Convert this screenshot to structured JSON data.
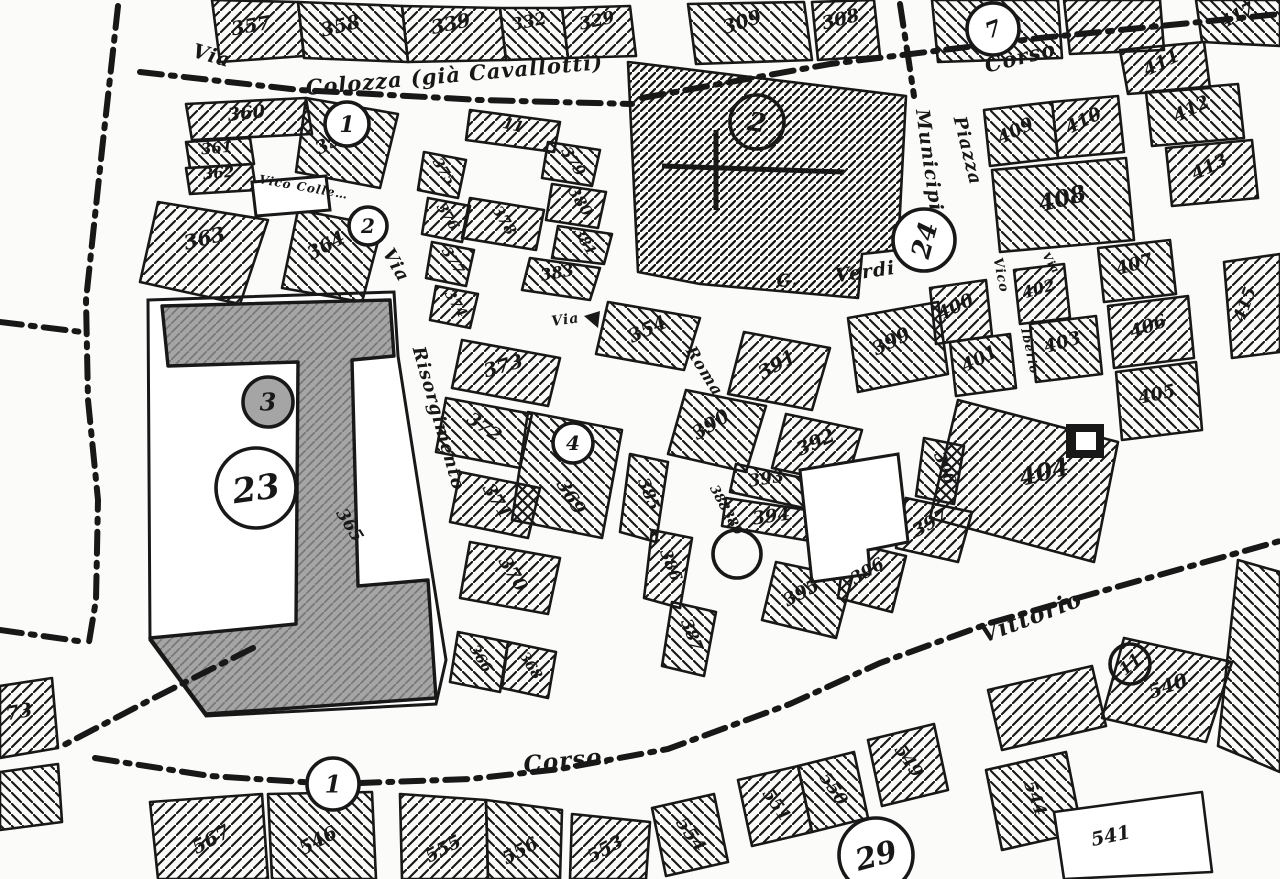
{
  "document": {
    "kind": "scanned black-and-white cadastral map",
    "language": "Italian"
  },
  "map": {
    "width": 1280,
    "height": 879,
    "colors": {
      "paper": "#fbfbf9",
      "ink": "#181818",
      "shade": "#a5a5a5",
      "shade_line": "#787878"
    },
    "street_labels": [
      {
        "t": "Via",
        "x": 210,
        "y": 62,
        "rot": 16,
        "fs": 20
      },
      {
        "t": "Colozza (già Cavallotti)",
        "x": 455,
        "y": 82,
        "rot": -5,
        "fs": 21
      },
      {
        "t": "Corso",
        "x": 1022,
        "y": 64,
        "rot": -14,
        "fs": 21
      },
      {
        "t": "Municipio",
        "x": 924,
        "y": 168,
        "rot": 82,
        "fs": 19
      },
      {
        "t": "Piazza",
        "x": 962,
        "y": 152,
        "rot": 76,
        "fs": 18
      },
      {
        "t": "G.",
        "x": 788,
        "y": 286,
        "rot": -5,
        "fs": 17
      },
      {
        "t": "Verdi",
        "x": 866,
        "y": 278,
        "rot": -8,
        "fs": 19
      },
      {
        "t": "Via",
        "x": 391,
        "y": 268,
        "rot": 60,
        "fs": 18
      },
      {
        "t": "Risorgimento",
        "x": 433,
        "y": 420,
        "rot": 74,
        "fs": 18
      },
      {
        "t": "Roma",
        "x": 700,
        "y": 374,
        "rot": 58,
        "fs": 16
      },
      {
        "t": "Via",
        "x": 566,
        "y": 324,
        "rot": -8,
        "fs": 14
      },
      {
        "t": "Vico Colle…",
        "x": 303,
        "y": 191,
        "rot": 10,
        "fs": 12
      },
      {
        "t": "Vico",
        "x": 997,
        "y": 276,
        "rot": 78,
        "fs": 13
      },
      {
        "t": "Iberio",
        "x": 1026,
        "y": 352,
        "rot": 78,
        "fs": 12
      },
      {
        "t": "Via",
        "x": 1048,
        "y": 265,
        "rot": 58,
        "fs": 11
      },
      {
        "t": "Corso.",
        "x": 568,
        "y": 768,
        "rot": -6,
        "fs": 23
      },
      {
        "t": "Vittorio",
        "x": 1034,
        "y": 624,
        "rot": -21,
        "fs": 23
      }
    ],
    "parcels": [
      {
        "n": "357",
        "pts": "212,0 298,2 304,56 220,62",
        "lx": 252,
        "ly": 32,
        "rot": -10,
        "fs": 19,
        "h": 0
      },
      {
        "n": "358",
        "pts": "298,2 402,6 408,62 304,58",
        "lx": 342,
        "ly": 32,
        "rot": -14,
        "fs": 19,
        "h": 1
      },
      {
        "n": "339",
        "pts": "402,6 500,8 506,60 408,62",
        "lx": 452,
        "ly": 30,
        "rot": -12,
        "fs": 19,
        "h": 0
      },
      {
        "n": "332",
        "pts": "500,8 562,8 568,58 506,60",
        "lx": 530,
        "ly": 27,
        "rot": -12,
        "fs": 17,
        "h": 1
      },
      {
        "n": "329",
        "pts": "562,8 630,6 636,56 568,58",
        "lx": 598,
        "ly": 26,
        "rot": -12,
        "fs": 17,
        "h": 0
      },
      {
        "n": "309",
        "pts": "688,4 804,2 812,60 696,64",
        "lx": 744,
        "ly": 28,
        "rot": -18,
        "fs": 19,
        "h": 1
      },
      {
        "n": "308",
        "pts": "812,2 874,0 880,56 818,60",
        "lx": 842,
        "ly": 25,
        "rot": -14,
        "fs": 18,
        "h": 0
      },
      {
        "n": "",
        "pts": "932,0 1058,0 1062,58 938,62",
        "h": 1
      },
      {
        "n": "",
        "pts": "1064,0 1160,0 1164,50 1070,54",
        "h": 0
      },
      {
        "n": "417",
        "pts": "1196,0 1280,0 1280,46 1202,42",
        "lx": 1240,
        "ly": 20,
        "rot": -28,
        "fs": 17,
        "h": 1
      },
      {
        "n": "411",
        "pts": "1120,50 1204,42 1210,88 1128,94",
        "lx": 1164,
        "ly": 68,
        "rot": -26,
        "fs": 18,
        "h": 0
      },
      {
        "n": "412",
        "pts": "1146,92 1238,84 1244,138 1152,146",
        "lx": 1194,
        "ly": 114,
        "rot": -26,
        "fs": 18,
        "h": 1
      },
      {
        "n": "413",
        "pts": "1166,148 1252,140 1258,198 1172,206",
        "lx": 1212,
        "ly": 172,
        "rot": -26,
        "fs": 18,
        "h": 0
      },
      {
        "n": "409",
        "pts": "984,110 1052,102 1058,158 990,166",
        "lx": 1018,
        "ly": 136,
        "rot": -26,
        "fs": 18,
        "h": 1
      },
      {
        "n": "410",
        "pts": "1052,102 1118,96 1124,152 1058,158",
        "lx": 1086,
        "ly": 126,
        "rot": -26,
        "fs": 18,
        "h": 0
      },
      {
        "n": "408",
        "pts": "992,170 1126,158 1134,240 1000,252",
        "lx": 1064,
        "ly": 206,
        "rot": -14,
        "fs": 23,
        "h": 1
      },
      {
        "n": "415",
        "pts": "1224,262 1280,254 1280,352 1232,358",
        "lx": 1250,
        "ly": 306,
        "rot": -70,
        "fs": 17,
        "h": 0
      },
      {
        "n": "407",
        "pts": "1098,248 1170,240 1176,294 1104,302",
        "lx": 1136,
        "ly": 270,
        "rot": -16,
        "fs": 18,
        "h": 1
      },
      {
        "n": "406",
        "pts": "1108,306 1188,296 1194,358 1114,368",
        "lx": 1150,
        "ly": 332,
        "rot": -20,
        "fs": 18,
        "h": 0
      },
      {
        "n": "405",
        "pts": "1116,372 1196,362 1202,430 1122,440",
        "lx": 1158,
        "ly": 400,
        "rot": -12,
        "fs": 18,
        "h": 1
      },
      {
        "n": "402",
        "pts": "1014,270 1064,264 1070,318 1020,324",
        "lx": 1040,
        "ly": 294,
        "rot": -16,
        "fs": 16,
        "h": 0
      },
      {
        "n": "403",
        "pts": "1030,324 1096,316 1102,374 1036,382",
        "lx": 1064,
        "ly": 348,
        "rot": -16,
        "fs": 18,
        "h": 1
      },
      {
        "n": "400",
        "pts": "930,288 986,280 992,336 936,344",
        "lx": 958,
        "ly": 312,
        "rot": -26,
        "fs": 18,
        "h": 0
      },
      {
        "n": "401",
        "pts": "950,342 1010,334 1016,388 956,396",
        "lx": 982,
        "ly": 364,
        "rot": -26,
        "fs": 18,
        "h": 1
      },
      {
        "n": "404",
        "pts": "958,400 1118,442 1094,562 930,518",
        "lx": 1046,
        "ly": 480,
        "rot": -14,
        "fs": 24,
        "h": 0
      },
      {
        "n": "399",
        "pts": "848,318 938,302 948,374 858,392",
        "lx": 894,
        "ly": 347,
        "rot": -26,
        "fs": 19,
        "h": 1
      },
      {
        "n": "391",
        "pts": "744,332 830,348 812,410 728,394",
        "lx": 780,
        "ly": 370,
        "rot": -30,
        "fs": 19,
        "h": 0
      },
      {
        "n": "390",
        "pts": "686,390 766,406 746,472 668,454",
        "lx": 714,
        "ly": 430,
        "rot": -32,
        "fs": 19,
        "h": 1
      },
      {
        "n": "392",
        "pts": "786,414 862,430 846,484 772,468",
        "lx": 818,
        "ly": 448,
        "rot": -24,
        "fs": 19,
        "h": 0
      },
      {
        "n": "393",
        "pts": "736,464 812,480 804,508 730,492",
        "lx": 767,
        "ly": 484,
        "rot": -9,
        "fs": 17,
        "h": 1
      },
      {
        "n": "394",
        "pts": "726,498 820,512 816,542 722,526",
        "lx": 772,
        "ly": 522,
        "rot": -8,
        "fs": 18,
        "h": 0
      },
      {
        "n": "388",
        "lx": 716,
        "ly": 500,
        "rot": 62,
        "fs": 13,
        "h": -1
      },
      {
        "n": "389",
        "lx": 729,
        "ly": 524,
        "rot": 62,
        "fs": 13,
        "h": -1
      },
      {
        "n": "395",
        "pts": "776,562 852,578 836,638 762,620",
        "lx": 804,
        "ly": 598,
        "rot": -28,
        "fs": 18,
        "h": 1
      },
      {
        "n": "396",
        "pts": "846,542 906,556 892,612 838,598",
        "lx": 870,
        "ly": 576,
        "rot": -30,
        "fs": 17,
        "h": 0
      },
      {
        "n": "396",
        "pts": "924,438 964,446 954,504 916,496",
        "lx": 940,
        "ly": 470,
        "rot": 68,
        "fs": 16,
        "h": 1
      },
      {
        "n": "397",
        "pts": "906,498 972,512 958,562 896,548",
        "lx": 933,
        "ly": 528,
        "rot": -30,
        "fs": 18,
        "h": 0
      },
      {
        "n": "385",
        "pts": "630,454 668,462 656,542 620,532",
        "lx": 644,
        "ly": 496,
        "rot": 68,
        "fs": 16,
        "h": 1
      },
      {
        "n": "386",
        "pts": "652,530 692,538 680,608 644,598",
        "lx": 666,
        "ly": 567,
        "rot": 68,
        "fs": 16,
        "h": 0
      },
      {
        "n": "387",
        "pts": "672,602 716,612 704,676 662,666",
        "lx": 687,
        "ly": 637,
        "rot": 68,
        "fs": 16,
        "h": 1
      },
      {
        "n": "11",
        "pts": "470,110 560,122 554,152 466,140",
        "lx": 512,
        "ly": 130,
        "rot": 14,
        "fs": 15,
        "h": 0
      },
      {
        "n": "379",
        "pts": "548,142 600,150 592,186 542,178",
        "lx": 569,
        "ly": 164,
        "rot": 58,
        "fs": 15,
        "h": 1
      },
      {
        "n": "380",
        "pts": "552,184 606,192 598,228 546,220",
        "lx": 576,
        "ly": 204,
        "rot": 58,
        "fs": 15,
        "h": 0
      },
      {
        "n": "381",
        "pts": "558,226 612,234 604,264 552,258",
        "lx": 581,
        "ly": 244,
        "rot": 58,
        "fs": 14,
        "h": 1
      },
      {
        "n": "378",
        "pts": "470,198 544,210 536,250 462,238",
        "lx": 500,
        "ly": 223,
        "rot": 58,
        "fs": 15,
        "h": 0
      },
      {
        "n": "383",
        "pts": "530,258 600,268 590,300 522,290",
        "lx": 558,
        "ly": 278,
        "rot": -10,
        "fs": 16,
        "h": 1
      },
      {
        "n": "375",
        "pts": "424,152 466,160 458,198 418,190",
        "lx": 440,
        "ly": 174,
        "rot": 58,
        "fs": 14,
        "h": 1
      },
      {
        "n": "376",
        "pts": "428,198 470,206 462,242 422,234",
        "lx": 444,
        "ly": 219,
        "rot": 58,
        "fs": 14,
        "h": 0
      },
      {
        "n": "377",
        "pts": "432,242 474,250 466,286 426,278",
        "lx": 449,
        "ly": 263,
        "rot": 58,
        "fs": 14,
        "h": 1
      },
      {
        "n": "374",
        "pts": "436,286 478,294 470,328 430,320",
        "lx": 452,
        "ly": 306,
        "rot": 58,
        "fs": 14,
        "h": 0
      },
      {
        "n": "354",
        "pts": "608,302 700,318 684,370 596,354",
        "lx": 650,
        "ly": 335,
        "rot": -24,
        "fs": 19,
        "h": 1
      },
      {
        "n": "373",
        "pts": "462,340 560,358 548,406 452,388",
        "lx": 505,
        "ly": 372,
        "rot": -16,
        "fs": 19,
        "h": 0
      },
      {
        "n": "372",
        "pts": "446,398 532,414 520,468 436,452",
        "lx": 481,
        "ly": 432,
        "rot": 34,
        "fs": 18,
        "h": 1
      },
      {
        "n": "371",
        "pts": "460,472 540,488 528,538 450,522",
        "lx": 492,
        "ly": 504,
        "rot": 58,
        "fs": 18,
        "h": 0
      },
      {
        "n": "369",
        "pts": "528,412 622,430 602,538 512,520",
        "lx": 566,
        "ly": 500,
        "rot": 58,
        "fs": 18,
        "h": 1
      },
      {
        "n": "370",
        "pts": "470,542 560,558 548,614 460,598",
        "lx": 508,
        "ly": 577,
        "rot": 58,
        "fs": 18,
        "h": 0
      },
      {
        "n": "366",
        "pts": "458,632 508,642 500,692 450,682",
        "lx": 477,
        "ly": 661,
        "rot": 58,
        "fs": 14,
        "h": 1
      },
      {
        "n": "368",
        "pts": "508,642 556,652 548,698 502,688",
        "lx": 527,
        "ly": 668,
        "rot": 58,
        "fs": 14,
        "h": 0
      },
      {
        "n": "360",
        "pts": "186,104 306,98 312,134 192,140",
        "lx": 247,
        "ly": 119,
        "rot": -6,
        "fs": 18,
        "h": 0
      },
      {
        "n": "359",
        "pts": "306,98 398,114 380,188 296,172",
        "lx": 336,
        "ly": 146,
        "rot": -28,
        "fs": 18,
        "h": 1
      },
      {
        "n": "361",
        "pts": "186,142 250,138 254,164 190,168",
        "lx": 217,
        "ly": 153,
        "rot": -5,
        "fs": 15,
        "h": 1
      },
      {
        "n": "362",
        "pts": "186,168 252,164 256,190 190,194",
        "lx": 219,
        "ly": 178,
        "rot": -5,
        "fs": 15,
        "h": 0
      },
      {
        "n": "363",
        "pts": "158,202 268,220 240,304 140,282",
        "lx": 206,
        "ly": 245,
        "rot": -14,
        "fs": 20,
        "h": 0
      },
      {
        "n": "364",
        "pts": "298,210 382,226 362,302 282,288",
        "lx": 329,
        "ly": 251,
        "rot": -28,
        "fs": 19,
        "h": 1
      },
      {
        "n": "365",
        "lx": 345,
        "ly": 528,
        "rot": 58,
        "fs": 17,
        "h": -1
      },
      {
        "n": "567",
        "pts": "150,802 262,794 268,879 158,879",
        "lx": 214,
        "ly": 845,
        "rot": -28,
        "fs": 19,
        "h": 0
      },
      {
        "n": "546",
        "pts": "268,794 372,792 376,879 272,879",
        "lx": 321,
        "ly": 846,
        "rot": -28,
        "fs": 19,
        "h": 1
      },
      {
        "n": "555",
        "pts": "400,794 486,800 488,879 402,879",
        "lx": 446,
        "ly": 854,
        "rot": -28,
        "fs": 18,
        "h": 0
      },
      {
        "n": "556",
        "pts": "486,800 562,810 560,879 488,879",
        "lx": 523,
        "ly": 856,
        "rot": -28,
        "fs": 18,
        "h": 1
      },
      {
        "n": "553",
        "pts": "572,814 650,822 646,879 570,879",
        "lx": 608,
        "ly": 854,
        "rot": -28,
        "fs": 18,
        "h": 0
      },
      {
        "n": "554",
        "pts": "652,808 714,794 728,862 666,876",
        "lx": 686,
        "ly": 838,
        "rot": 55,
        "fs": 18,
        "h": 1
      },
      {
        "n": "551",
        "pts": "738,780 798,766 812,832 752,846",
        "lx": 772,
        "ly": 808,
        "rot": 55,
        "fs": 17,
        "h": 0
      },
      {
        "n": "550",
        "pts": "798,766 854,752 868,818 812,832",
        "lx": 829,
        "ly": 792,
        "rot": 55,
        "fs": 17,
        "h": 1
      },
      {
        "n": "549",
        "pts": "868,740 934,724 948,790 882,806",
        "lx": 904,
        "ly": 764,
        "rot": 55,
        "fs": 17,
        "h": 0
      },
      {
        "n": "544",
        "pts": "986,770 1066,752 1082,832 1002,850",
        "lx": 1030,
        "ly": 800,
        "rot": 70,
        "fs": 17,
        "h": 1
      },
      {
        "n": "541",
        "pts": "1054,812 1202,792 1212,872 1064,879",
        "lx": 1112,
        "ly": 842,
        "rot": -12,
        "fs": 19,
        "h": "white"
      },
      {
        "n": "540",
        "pts": "1124,638 1232,662 1206,742 1102,718",
        "lx": 1170,
        "ly": 692,
        "rot": -20,
        "fs": 19,
        "h": 0
      },
      {
        "n": "",
        "pts": "1238,560 1280,572 1280,772 1218,746",
        "h": 1
      },
      {
        "n": "73",
        "pts": "0,686 52,678 58,748 0,758",
        "lx": 20,
        "ly": 718,
        "rot": -10,
        "fs": 19,
        "h": 0
      },
      {
        "n": "",
        "pts": "0,772 58,764 62,822 0,830",
        "h": 1
      },
      {
        "n": "",
        "pts": "988,690 1092,666 1106,726 1002,750",
        "h": 0
      },
      {
        "n": "",
        "pts": "628,62 906,96 898,250 862,254 858,298 700,284 638,272",
        "h": 2
      }
    ],
    "circles": [
      {
        "n": "1",
        "cx": 347,
        "cy": 124,
        "r": 22,
        "fs": 22,
        "rot": 0,
        "fill": "white"
      },
      {
        "n": "2",
        "cx": 368,
        "cy": 226,
        "r": 19,
        "fs": 20,
        "rot": 0,
        "fill": "white"
      },
      {
        "n": "2",
        "cx": 757,
        "cy": 122,
        "r": 27,
        "fs": 26,
        "rot": 10,
        "fill": "none"
      },
      {
        "n": "24",
        "cx": 924,
        "cy": 240,
        "r": 31,
        "fs": 26,
        "rot": -75,
        "fill": "white"
      },
      {
        "n": "4",
        "cx": 573,
        "cy": 443,
        "r": 20,
        "fs": 20,
        "rot": 0,
        "fill": "white"
      },
      {
        "n": "3",
        "cx": 268,
        "cy": 402,
        "r": 25,
        "fs": 24,
        "rot": 0,
        "fill": "gray"
      },
      {
        "n": "23",
        "cx": 256,
        "cy": 488,
        "r": 40,
        "fs": 34,
        "rot": -8,
        "fill": "white"
      },
      {
        "n": "7",
        "cx": 993,
        "cy": 29,
        "r": 26,
        "fs": 22,
        "rot": -20,
        "fill": "white"
      },
      {
        "n": "1",
        "cx": 333,
        "cy": 784,
        "r": 26,
        "fs": 24,
        "rot": 0,
        "fill": "white"
      },
      {
        "n": "29",
        "cx": 876,
        "cy": 855,
        "r": 37,
        "fs": 30,
        "rot": -15,
        "fill": "white"
      },
      {
        "n": "11",
        "cx": 1130,
        "cy": 664,
        "r": 20,
        "fs": 17,
        "rot": -40,
        "fill": "none"
      },
      {
        "n": "",
        "cx": 737,
        "cy": 554,
        "r": 24,
        "fs": 0,
        "rot": 0,
        "fill": "none"
      }
    ],
    "boundary_lines": [
      {
        "pts": "140,72 300,90 480,100 632,104",
        "w": 6
      },
      {
        "pts": "642,98 830,64 1040,38 1280,14",
        "w": 6
      },
      {
        "pts": "118,6 102,150 86,300 88,400 98,500 96,600 88,648",
        "w": 6
      },
      {
        "pts": "0,322 82,332",
        "w": 6
      },
      {
        "pts": "0,630 78,641",
        "w": 6
      },
      {
        "pts": "253,648 150,700 62,746",
        "w": 6
      },
      {
        "pts": "95,758 210,776 333,784 470,779 560,769 668,749 790,704 880,663 990,623 1120,586 1280,541",
        "w": 6
      },
      {
        "pts": "900,4 908,56 914,96",
        "w": 6
      }
    ],
    "shapes": {
      "block_outline": "148,300 394,292 398,356 430,560 446,660 436,704 206,716 150,640",
      "gray_building": "162,306 390,300 394,356 352,360 358,586 428,580 436,698 206,714 150,638 296,624 298,362 168,366",
      "white_buildings": [
        "800,470 898,454 908,542 868,550 870,574 812,582",
        "252,182 326,176 330,210 256,216"
      ],
      "church_cross": {
        "v": "716,130 716,210",
        "h": "662,166 844,172"
      },
      "square_404": {
        "outer": [
          1066,
          424,
          38,
          34
        ],
        "inner": [
          1076,
          432,
          20,
          18
        ]
      },
      "via_arrow": "584,316 600,311 598,328"
    }
  }
}
